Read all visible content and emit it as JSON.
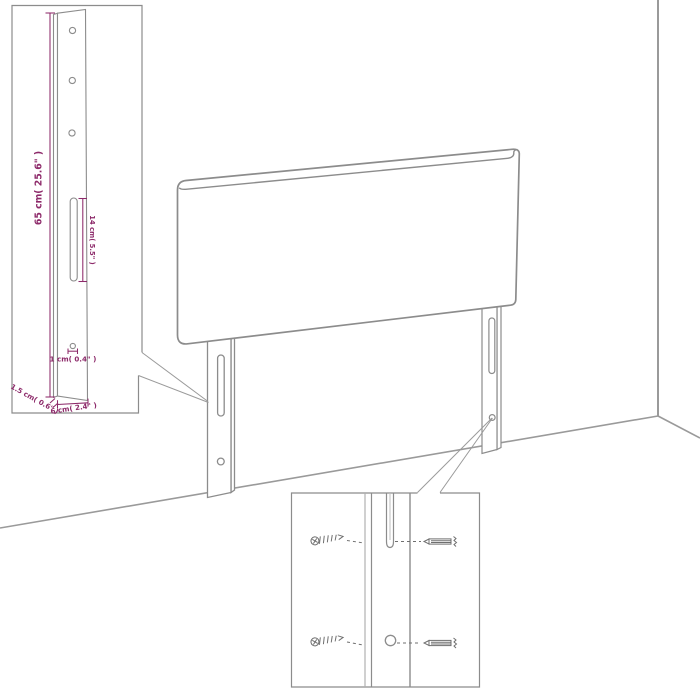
{
  "colors": {
    "background": "#ffffff",
    "line": "#8c8c8c",
    "accent_dimension": "#8d2a6a"
  },
  "dimensions": {
    "height": "65 cm( 25.6\" )",
    "slot_length": "14 cm( 5.5\" )",
    "hole": "1 cm( 0.4\" )",
    "edge_thickness": "1.5 cm( 0.6\" )",
    "leg_width": "6 cm( 2.4\" )"
  }
}
